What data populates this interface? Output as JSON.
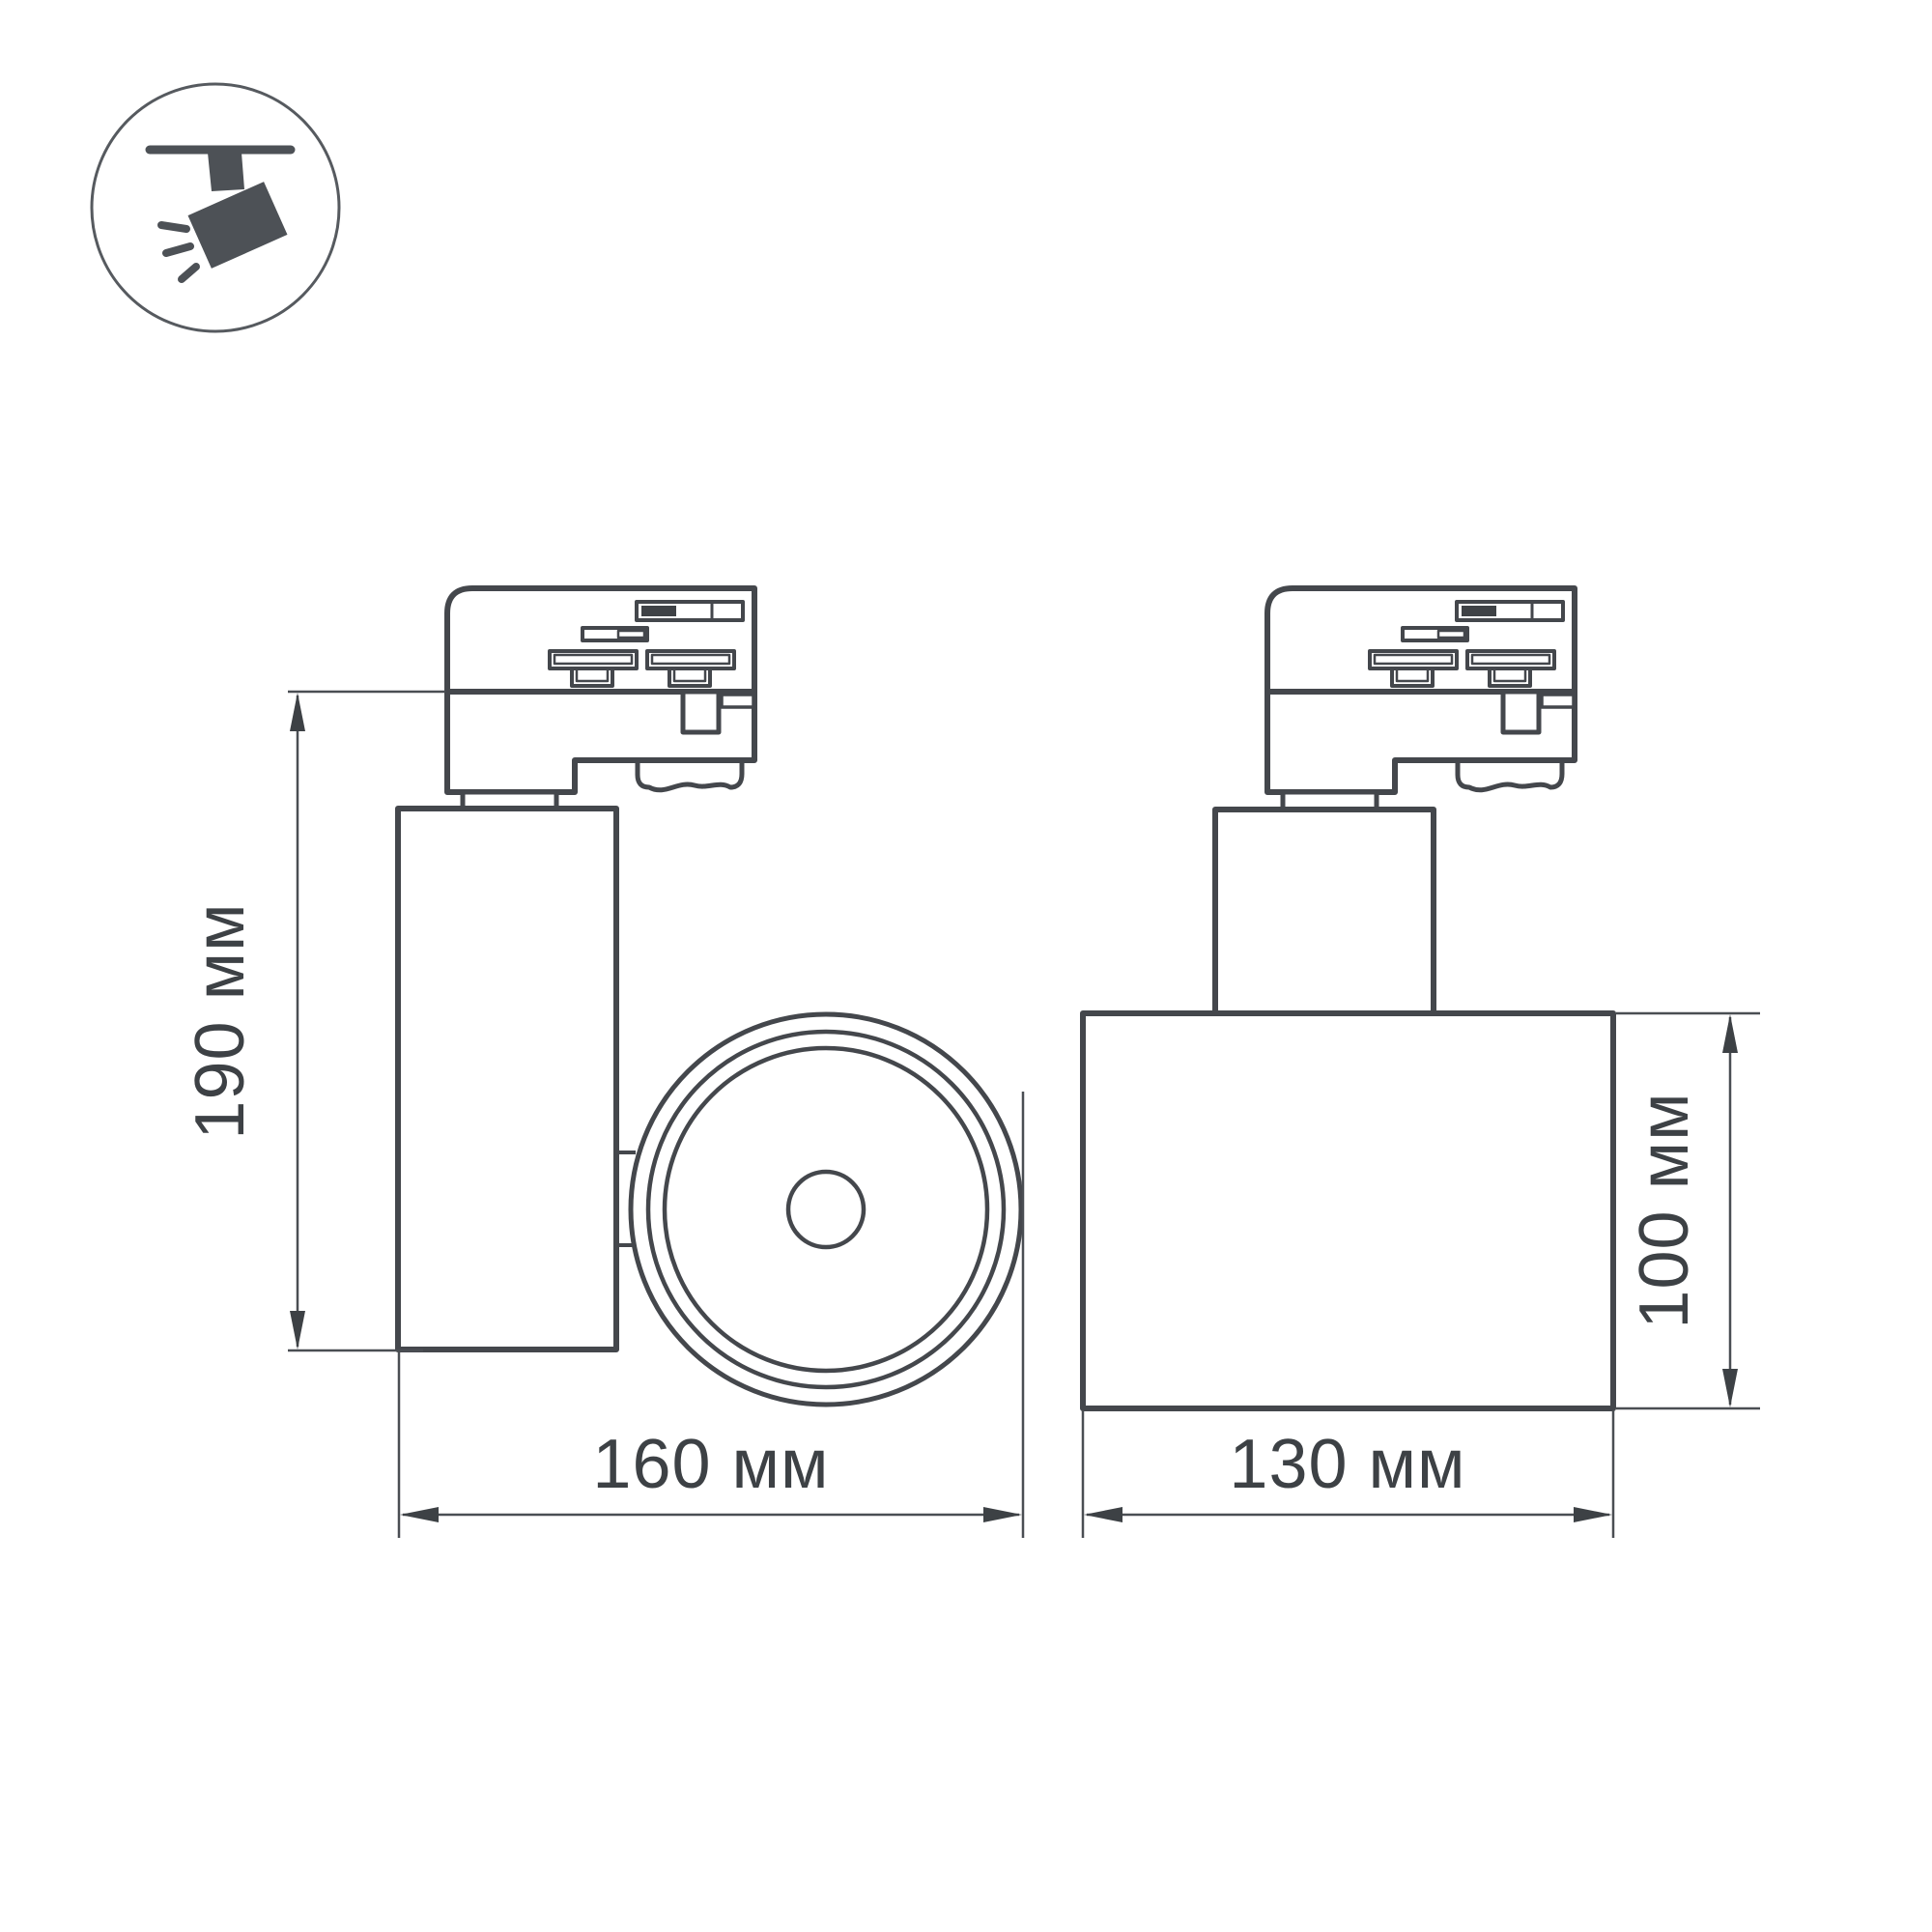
{
  "badge": {
    "icon": "track-spotlight-icon"
  },
  "drawing": {
    "stroke_color": "#44474c",
    "thin_line_color": "#4a4e53",
    "text_color": "#3d4145",
    "icon_fill_color": "#4d5156",
    "background": "#ffffff"
  },
  "views": {
    "front": {
      "name": "front-view-track-spotlight",
      "height_label": "190 мм",
      "width_label": "160 мм"
    },
    "side": {
      "name": "side-view-track-spotlight",
      "width_label": "130 мм",
      "height_label": "100 мм"
    }
  }
}
